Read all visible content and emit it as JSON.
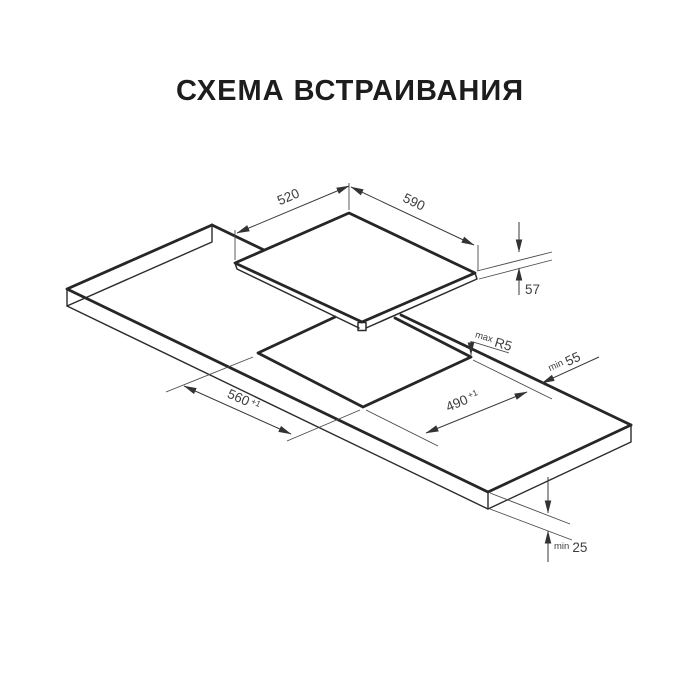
{
  "title": "СХЕМА ВСТРАИВАНИЯ",
  "dimensions": {
    "hob_width": "520",
    "hob_depth": "590",
    "hob_height": "57",
    "cutout_length": "560",
    "cutout_length_tol": "+1",
    "cutout_width": "490",
    "cutout_width_tol": "+1",
    "corner_radius_prefix": "max",
    "corner_radius": "R5",
    "rear_clearance_prefix": "min",
    "rear_clearance": "55",
    "worktop_thickness_prefix": "min",
    "worktop_thickness": "25"
  }
}
